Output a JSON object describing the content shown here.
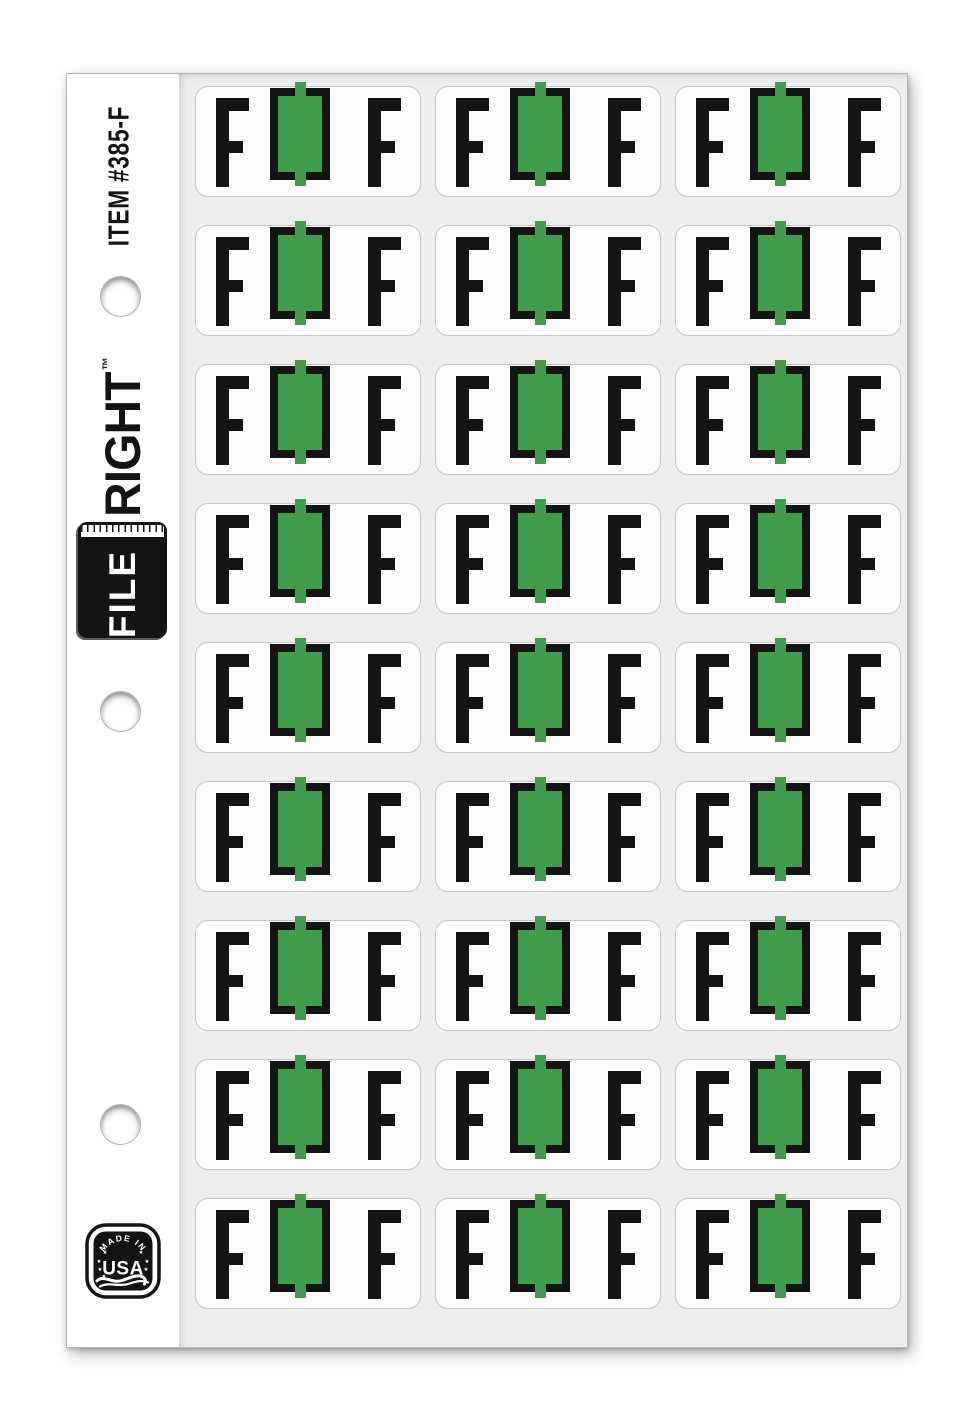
{
  "page": {
    "item_number": "ITEM #385-F",
    "brand": {
      "file": "FILE",
      "right": "RIGHT",
      "trademark": "™"
    },
    "badge": {
      "top_text": "MADE IN",
      "main_text": "USA",
      "star": "★"
    },
    "sheet": {
      "rows": 9,
      "columns": 3,
      "label_count": 27,
      "label": {
        "left_letter": "F",
        "right_letter": "F",
        "tab_color_name": "green"
      }
    },
    "holes": {
      "count": 3
    },
    "colors": {
      "tab_green": "#3f9d4b",
      "ink_black": "#141414",
      "sheet_gray": "#ededee",
      "label_white": "#fbfbfc",
      "page_white": "#ffffff"
    }
  }
}
